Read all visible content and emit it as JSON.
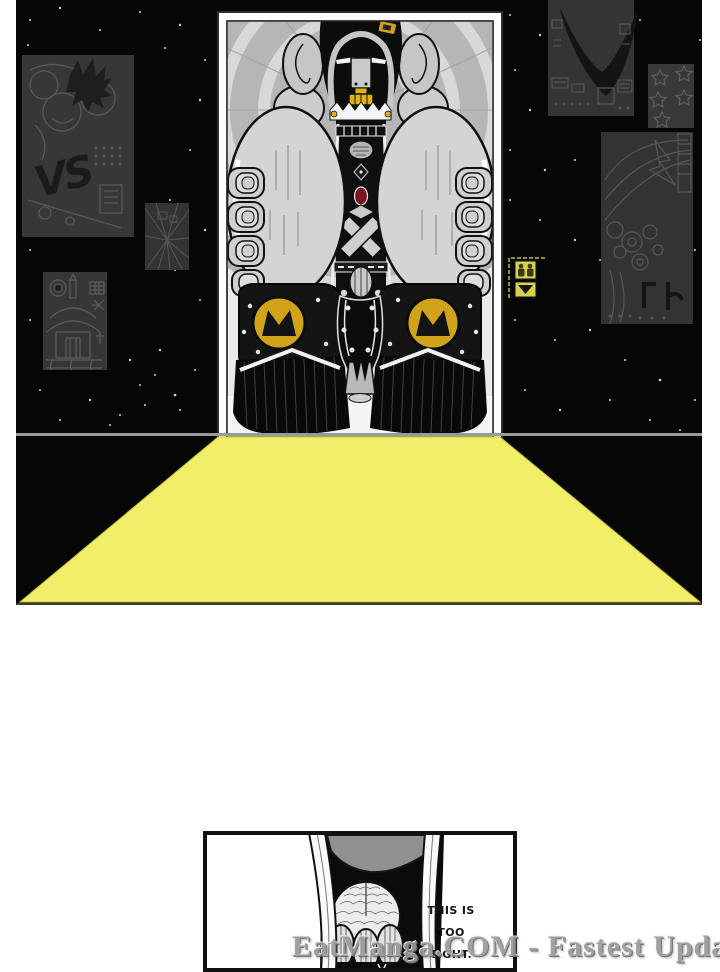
{
  "page": {
    "watermark_text": "EatManga.COM - Fastest Updates"
  },
  "panel1": {
    "vs_poster_label": "VS",
    "colors": {
      "beam_yellow": "#f1ee68",
      "shoe_logo_gold": "#d0a31a",
      "teeth_gold": "#ddb117",
      "elevator_indicator_yellow": "#d6d14f",
      "wall_black": "#060606",
      "poster_grey": "#373737"
    },
    "elevator_indicator": {
      "occupants_icon": "elevator-occupants-icon",
      "down_arrow_icon": "elevator-down-arrow-icon"
    },
    "shoe_logo_icon": "crown-m-logo-icon"
  },
  "panel2": {
    "speech_lines": [
      "THIS IS",
      "TOO",
      "TIGHT."
    ]
  }
}
